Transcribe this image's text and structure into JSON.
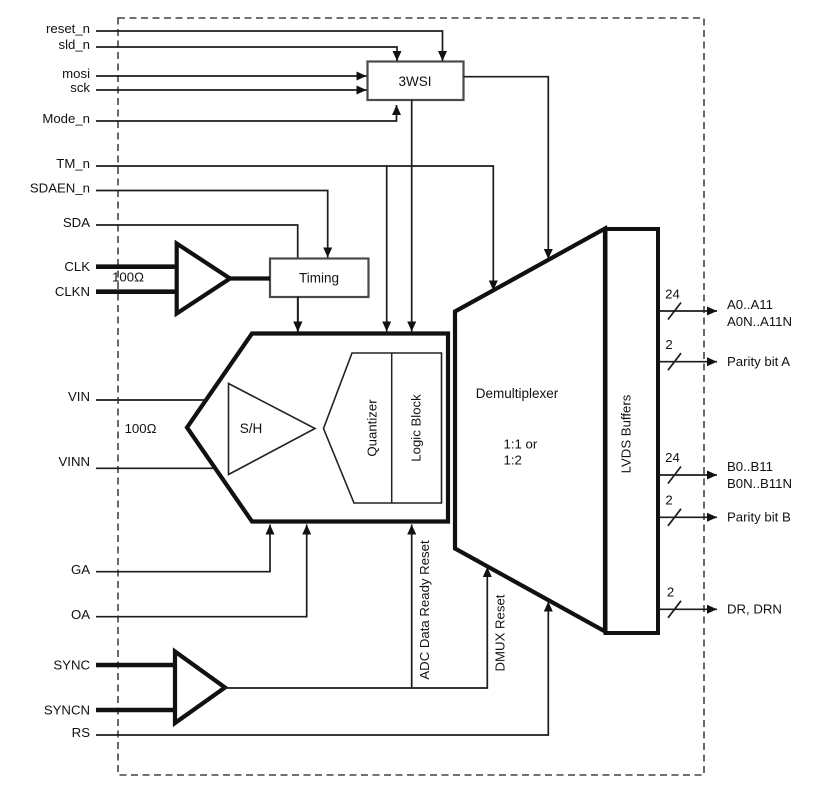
{
  "diagram": {
    "title_hint": "ADC functional block diagram",
    "pins": {
      "reset_n": "reset_n",
      "sld_n": "sld_n",
      "mosi": "mosi",
      "sck": "sck",
      "mode_n": "Mode_n",
      "tm_n": "TM_n",
      "sdaen_n": "SDAEN_n",
      "sda": "SDA",
      "clk": "CLK",
      "clkn": "CLKN",
      "vin": "VIN",
      "vinn": "VINN",
      "ga": "GA",
      "oa": "OA",
      "sync": "SYNC",
      "syncn": "SYNCN",
      "rs": "RS"
    },
    "blocks": {
      "wsi": "3WSI",
      "timing": "Timing",
      "sample_hold": "S/H",
      "quantizer": "Quantizer",
      "logic_block": "Logic Block",
      "demux_line1": "Demultiplexer",
      "demux_line2": "1:1 or",
      "demux_line3": "1:2",
      "lvds": "LVDS Buffers"
    },
    "resistors": {
      "clk_term": "100Ω",
      "vin_term": "100Ω"
    },
    "internal_signals": {
      "adc_data_ready_reset": "ADC Data Ready Reset",
      "dmux_reset": "DMUX Reset"
    },
    "outputs": [
      {
        "bus": "24",
        "label": "A0..A11",
        "label2": "A0N..A11N"
      },
      {
        "bus": "2",
        "label": "Parity bit A"
      },
      {
        "bus": "24",
        "label": "B0..B11",
        "label2": "B0N..B11N"
      },
      {
        "bus": "2",
        "label": "Parity bit B"
      },
      {
        "bus": "2",
        "label": "DR, DRN"
      }
    ],
    "colors": {
      "line": "#1c1c1c",
      "shape_stroke": "#111111",
      "box_stroke": "#4a4a4a",
      "background": "#ffffff"
    }
  }
}
